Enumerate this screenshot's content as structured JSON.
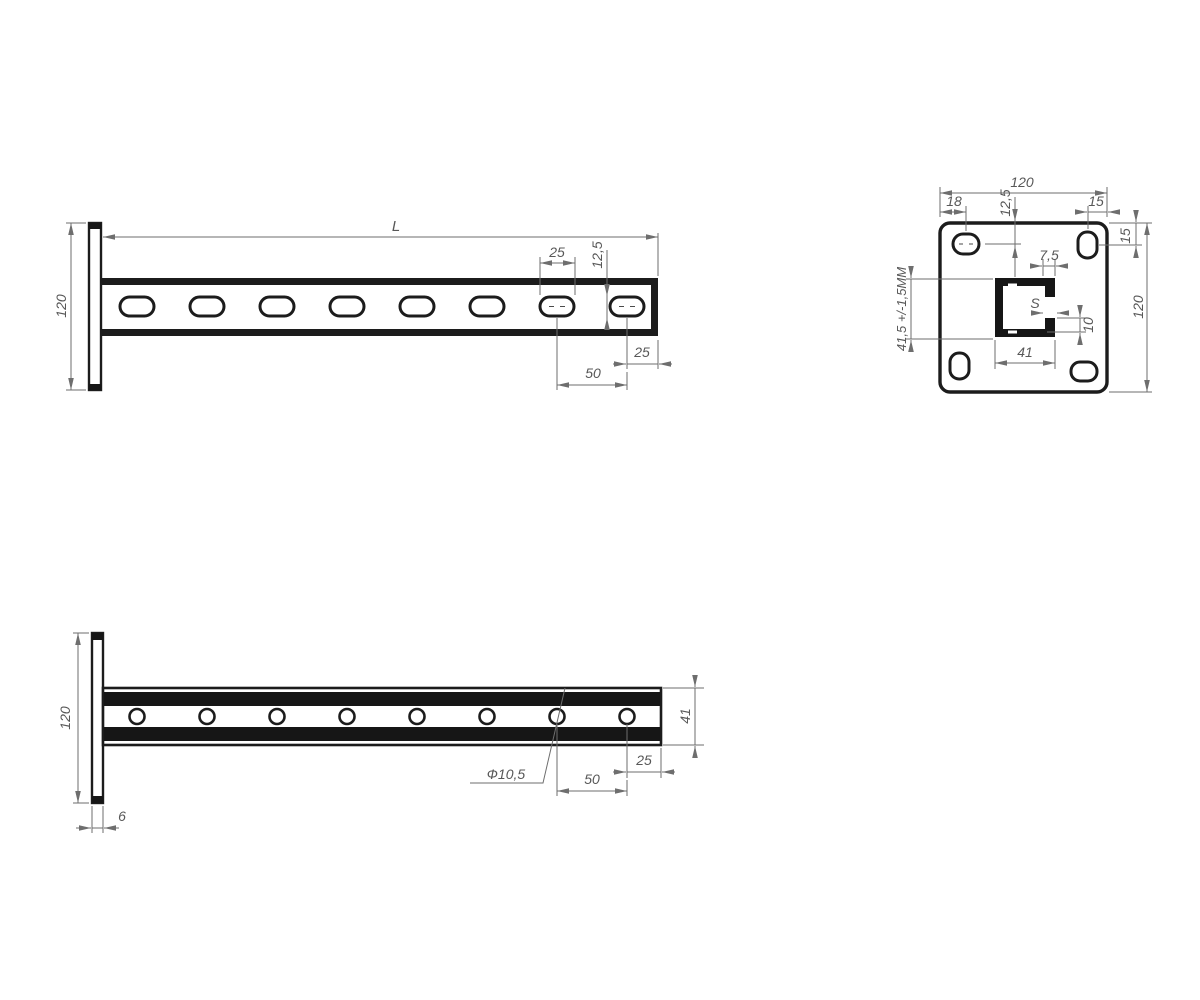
{
  "drawing": {
    "type": "technical-drawing-cantilever-bracket",
    "front": {
      "length": "L",
      "height": "120",
      "slot_length": "25",
      "slot_width": "12,5",
      "end_offset": "25",
      "pitch": "50"
    },
    "plate": {
      "width": "120",
      "height_right": "120",
      "hole_left": "18",
      "hole_top": "12,5",
      "hole_right": "15",
      "hole_top_right": "15",
      "lip_width": "7,5",
      "wall_thickness": "S",
      "lip_height": "10",
      "channel_width": "41",
      "channel_height": "41,5 +/-1,5ММ"
    },
    "top": {
      "height": "120",
      "channel_width": "41",
      "hole_dia": "Ф10,5",
      "pitch": "50",
      "end_offset": "25",
      "plate_thickness": "6"
    }
  }
}
